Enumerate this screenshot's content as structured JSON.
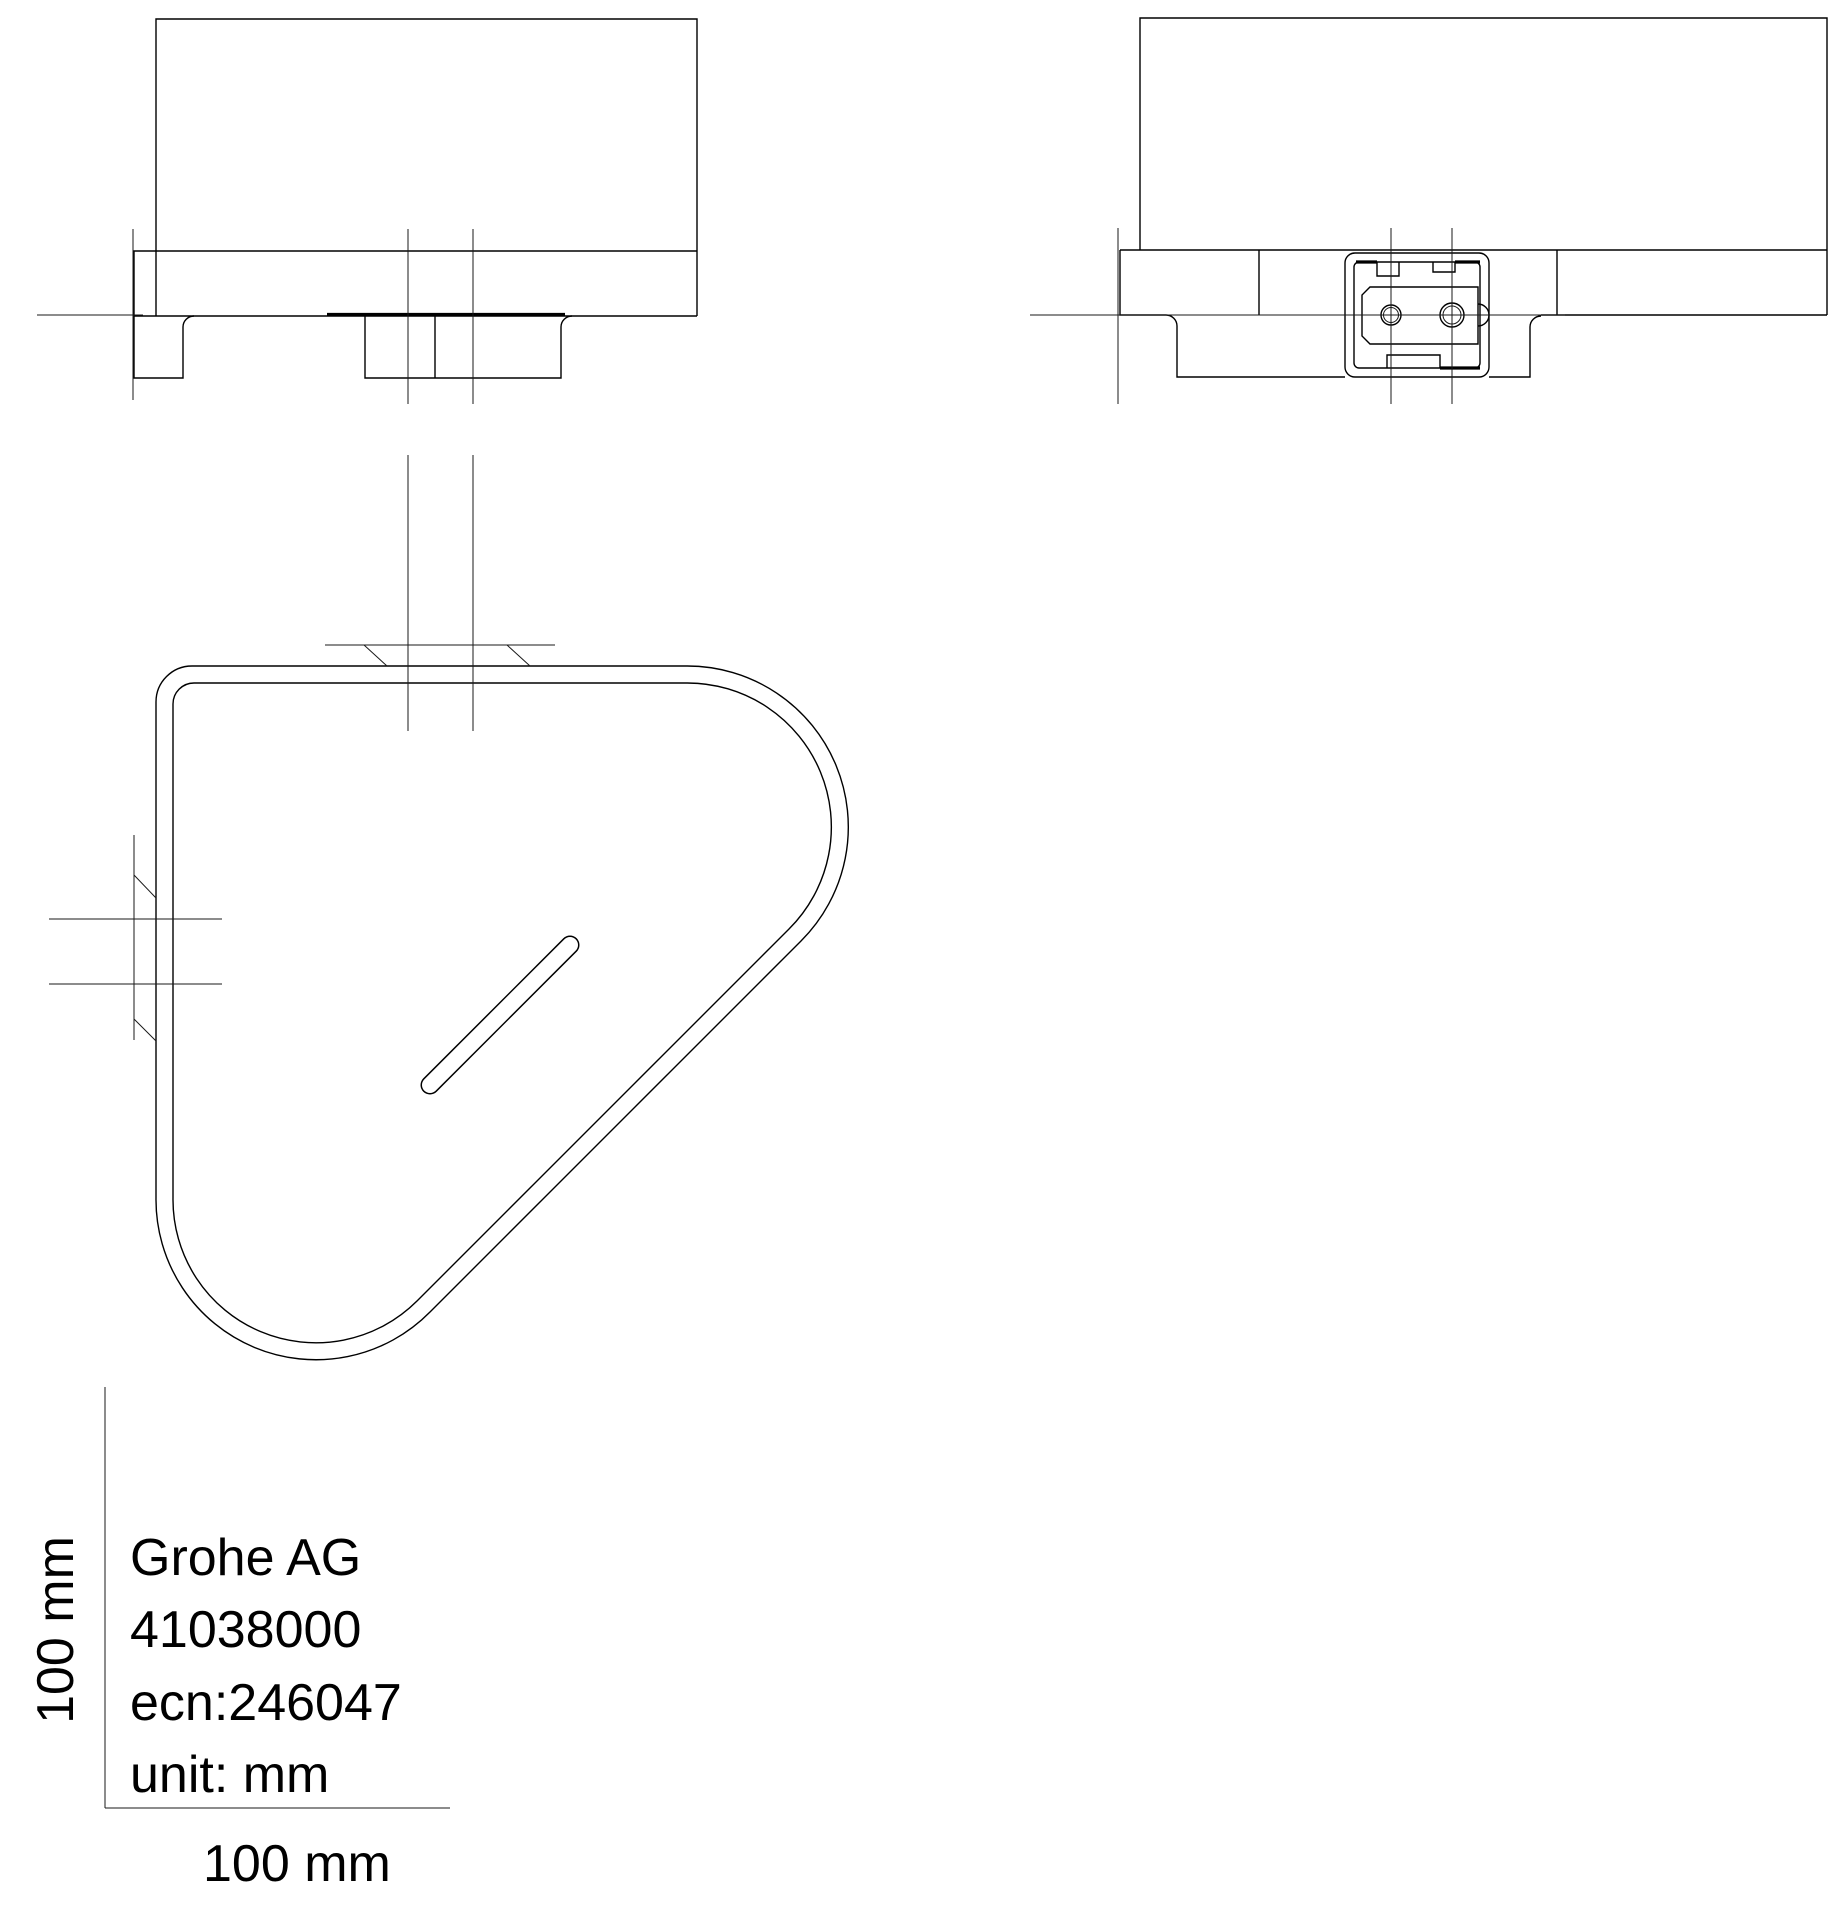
{
  "title_block": {
    "company": "Grohe AG",
    "product_number": "41038000",
    "ecn": "ecn:246047",
    "unit": "unit: mm"
  },
  "scale_ruler": {
    "vertical_label": "100 mm",
    "horizontal_label": "100 mm"
  },
  "drawing": {
    "background_color": "#ffffff",
    "line_color": "#000000"
  }
}
